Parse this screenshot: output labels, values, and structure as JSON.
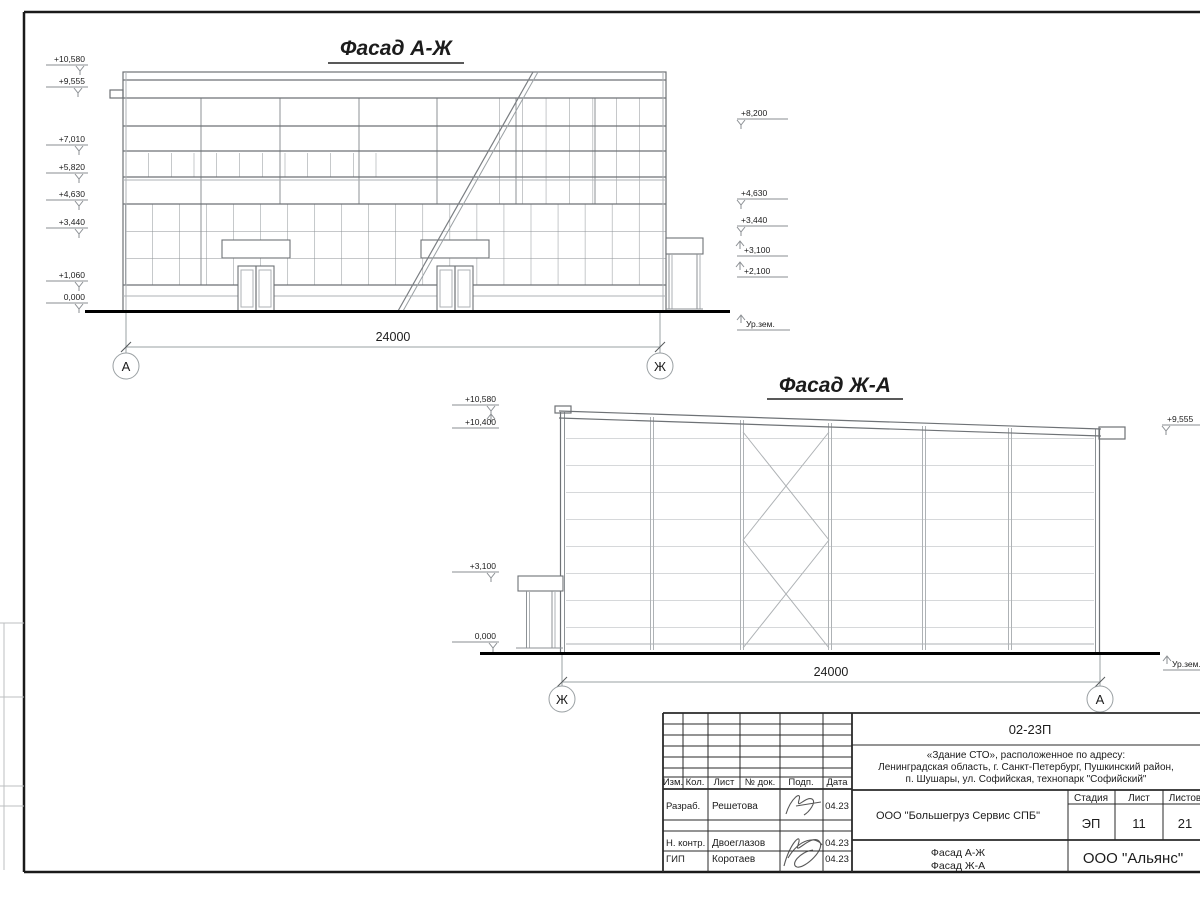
{
  "facade1": {
    "title": "Фасад А-Ж",
    "dimension": "24000",
    "axis_left": "А",
    "axis_right": "Ж",
    "marks_left": [
      "+10,580",
      "+9,555",
      "+7,010",
      "+5,820",
      "+4,630",
      "+3,440",
      "+1,060",
      "0,000"
    ],
    "marks_right": [
      "+8,200",
      "+4,630",
      "+3,440",
      "+3,100",
      "+2,100",
      "Ур.зем."
    ]
  },
  "facade2": {
    "title": "Фасад Ж-А",
    "dimension": "24000",
    "axis_left": "Ж",
    "axis_right": "А",
    "marks_left": [
      "+10,580",
      "+10,400",
      "+3,100",
      "0,000"
    ],
    "marks_right": [
      "+9,555",
      "Ур.зем."
    ]
  },
  "titleblock": {
    "doc_number": "02-23П",
    "project_line1": "«Здание СТО», расположенное по адресу:",
    "project_line2": "Ленинградская область, г. Санкт-Петербург, Пушкинский район,",
    "project_line3": "п. Шушары, ул. Софийская, технопарк \"Софийский\"",
    "client": "ООО \"Большегруз Сервис СПБ\"",
    "stage_label": "Стадия",
    "sheet_label": "Лист",
    "sheets_label": "Листов",
    "stage": "ЭП",
    "sheet": "11",
    "sheets": "21",
    "sheet_title_line1": "Фасад А-Ж",
    "sheet_title_line2": "Фасад Ж-А",
    "org": "ООО \"Альянс\"",
    "columns": [
      "Изм.",
      "Кол.",
      "Лист",
      "№ док.",
      "Подп.",
      "Дата"
    ],
    "rows": [
      {
        "role": "Разраб.",
        "name": "Решетова",
        "date": "04.23"
      },
      {
        "role": "Н. контр.",
        "name": "Двоеглазов",
        "date": "04.23"
      },
      {
        "role": "ГИП",
        "name": "Коротаев",
        "date": "04.23"
      }
    ]
  }
}
